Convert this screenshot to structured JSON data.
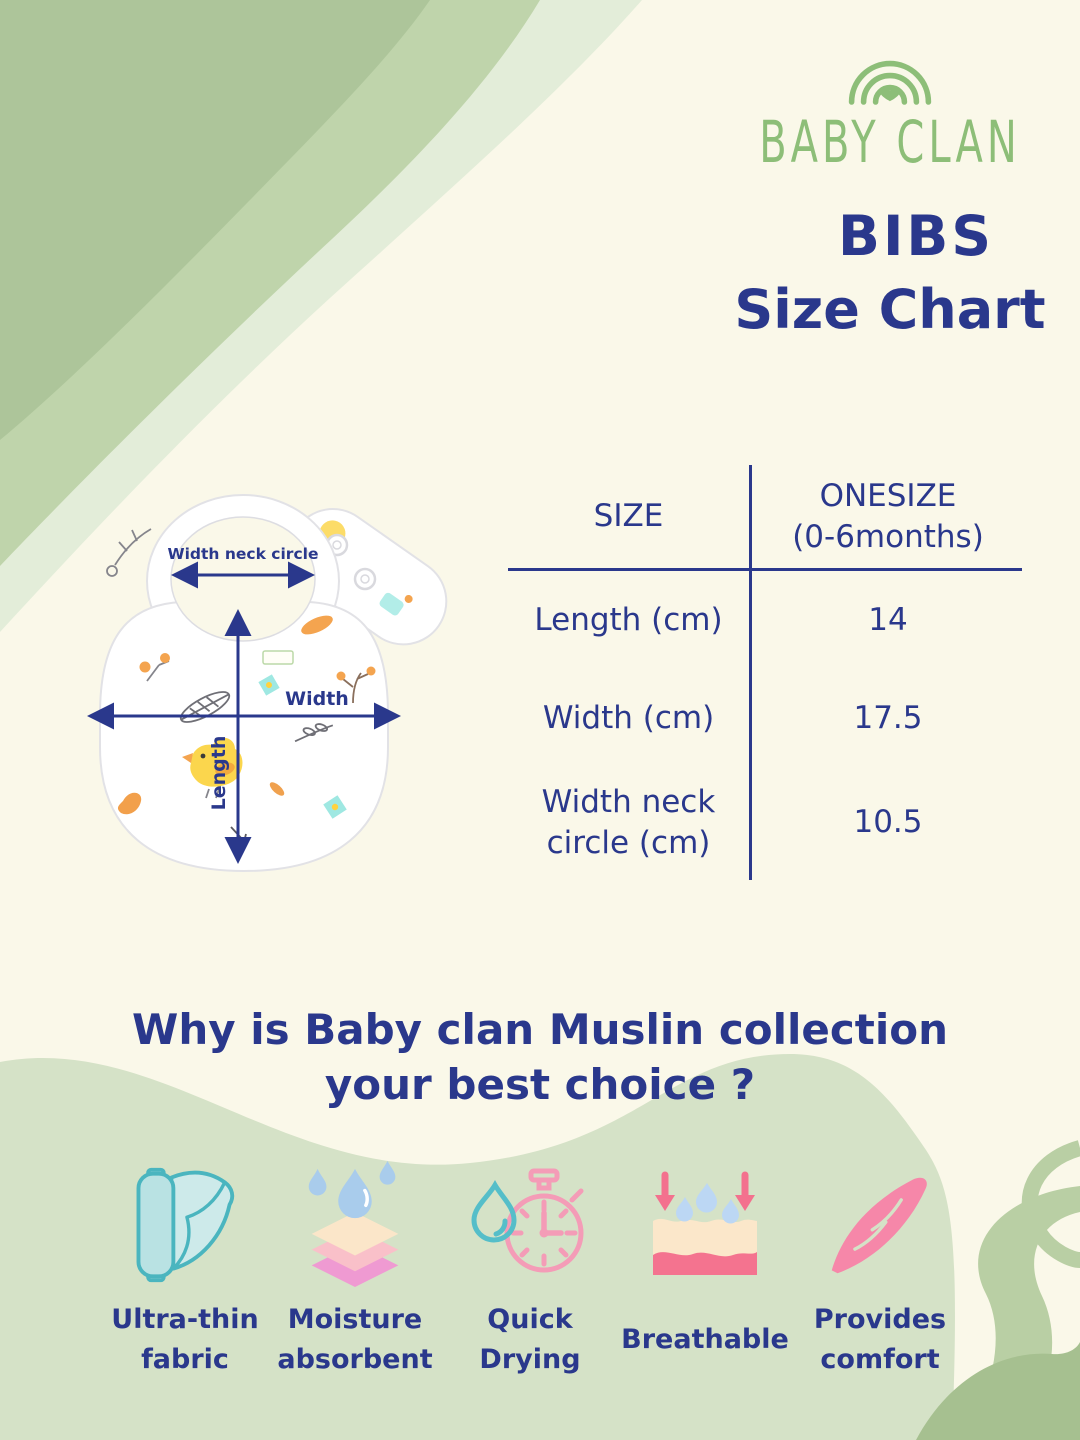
{
  "colors": {
    "background": "#faf8e9",
    "navy_text": "#2a388c",
    "logo_green": "#8dbe78",
    "corner_green_dark": "#abc497",
    "corner_green_mid": "#bfd4ab",
    "corner_green_light": "#e3edd9",
    "bottom_blob_green": "#d5e2c7",
    "swirl_green": "#b9cfa4",
    "icon_teal": "#4ab5bf",
    "icon_pink": "#f3718e",
    "icon_blue": "#a9ccec"
  },
  "brand": {
    "name": "BABY CLAN",
    "product": "BIBS",
    "chart_title": "Size Chart"
  },
  "bib_diagram": {
    "neck_label": "Width neck circle",
    "width_label": "Width",
    "length_label": "Length"
  },
  "size_table": {
    "col1_header": "SIZE",
    "col2_header": "ONESIZE\n(0-6months)",
    "rows": [
      {
        "label": "Length (cm)",
        "value": "14"
      },
      {
        "label": "Width (cm)",
        "value": "17.5"
      },
      {
        "label": "Width neck\ncircle (cm)",
        "value": "10.5"
      }
    ]
  },
  "chart_data": {
    "type": "table",
    "title": "BIBS Size Chart",
    "columns": [
      "SIZE",
      "ONESIZE (0-6months)"
    ],
    "rows": [
      [
        "Length (cm)",
        14
      ],
      [
        "Width (cm)",
        17.5
      ],
      [
        "Width neck circle (cm)",
        10.5
      ]
    ]
  },
  "question": {
    "line1": "Why is Baby clan Muslin collection",
    "line2": "your best choice ?"
  },
  "features": [
    {
      "label": "Ultra-thin\nfabric",
      "icon": "fabric-roll-icon"
    },
    {
      "label": "Moisture\nabsorbent",
      "icon": "moisture-layers-icon"
    },
    {
      "label": "Quick\nDrying",
      "icon": "stopwatch-drop-icon"
    },
    {
      "label": "Breathable",
      "icon": "breathable-fabric-icon"
    },
    {
      "label": "Provides\ncomfort",
      "icon": "feather-icon"
    }
  ]
}
